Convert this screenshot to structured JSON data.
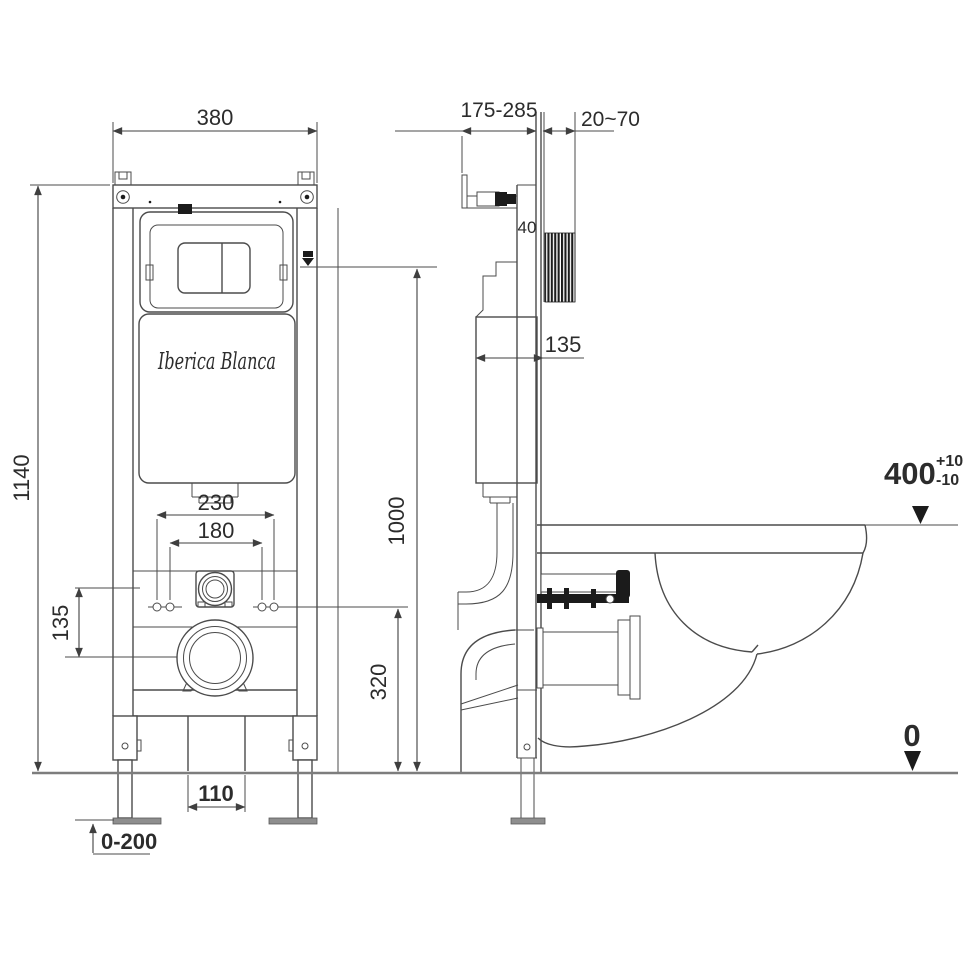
{
  "brand": {
    "logo_text": "Iberica Blanca"
  },
  "front_view": {
    "dims": {
      "width": "380",
      "height": "1140",
      "bolt_spacing_outer": "230",
      "bolt_spacing_inner": "180",
      "inlet_drop": "135",
      "outlet_width": "110",
      "foot_adjust": "0-200",
      "drain_center_height": "320",
      "panel_height": "1000"
    }
  },
  "side_view": {
    "dims": {
      "frame_depth_range": "175-285",
      "wall_gap_range": "20~70",
      "rail_depth": "40",
      "cistern_depth": "135"
    },
    "levels": {
      "seat_height": "400",
      "tol_plus": "+10",
      "tol_minus": "-10",
      "floor": "0"
    }
  }
}
